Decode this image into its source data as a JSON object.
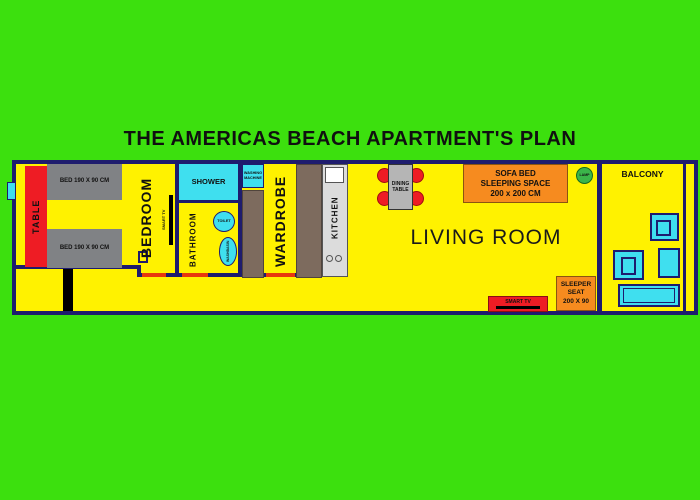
{
  "title": "THE AMERICAS BEACH APARTMENT'S PLAN",
  "rooms": {
    "bedroom": "BEDROOM",
    "bathroom": "BATHROOM",
    "shower": "SHOWER",
    "wardrobe": "WARDROBE",
    "kitchen": "KITCHEN",
    "living_room": "LIVING ROOM",
    "balcony": "BALCONY"
  },
  "furniture": {
    "table": "TABLE",
    "bed_top": "BED 190 X 90 CM",
    "bed_bottom": "BED 190 X 90 CM",
    "smart_tv_bedroom": "SMART TV",
    "toilet": "TOILET",
    "washbasin": "WASHBASIN",
    "washing_machine": {
      "line1": "WASHING",
      "line2": "MACHINE"
    },
    "dining_table": {
      "line1": "DINING",
      "line2": "TABLE"
    },
    "sofa_bed": {
      "line1": "SOFA BED",
      "line2": "SLEEPING SPACE",
      "line3": "200 x 200 CM"
    },
    "lamp": "LAMP",
    "sleeper_seat": {
      "line1": "SLEEPER",
      "line2": "SEAT",
      "line3": "200 X 90"
    },
    "smart_tv_living": "SMART TV"
  },
  "colors": {
    "background_green": "#3ce00e",
    "wall_navy": "#1e1c6e",
    "floor_yellow": "#fff200",
    "accent_red": "#ee1c24",
    "water_cyan": "#3fdfef",
    "accent_orange": "#f68b1f",
    "bed_gray": "#808285",
    "wardrobe_brown": "#7d6b5e",
    "lamp_green": "#3bb54a",
    "door_opening_red": "#e8380d"
  }
}
